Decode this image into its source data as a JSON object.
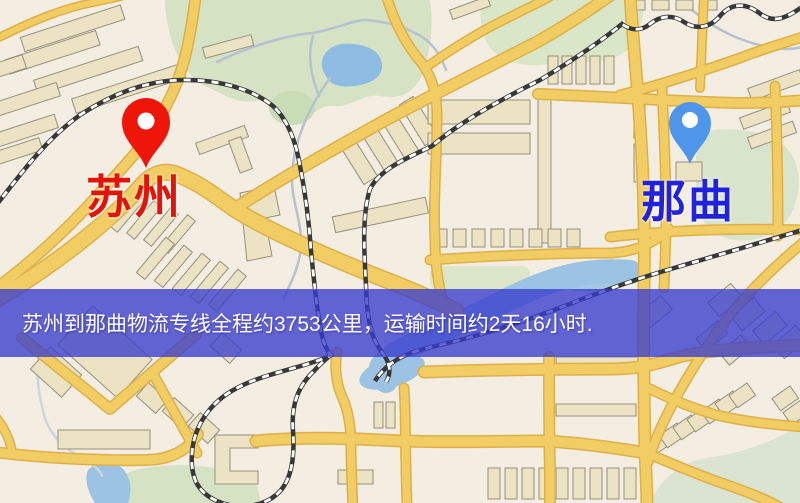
{
  "banner": {
    "text": "苏州到那曲物流专线全程约3753公里，运输时间约2天16小时."
  },
  "markers": {
    "origin": {
      "label": "苏州",
      "label_color": "#e21407",
      "pin_color": "#ee1509"
    },
    "destination": {
      "label": "那曲",
      "label_color": "#2123dc",
      "pin_color": "#4f95ea"
    }
  },
  "map_colors": {
    "background": "#f4ede2",
    "road_fill": "#f2cd63",
    "road_casing": "#ddb04a",
    "building": "#ece2c4",
    "building_outline": "#96907b",
    "park_green": "#d5e3c4",
    "water_blue": "#8fbce2",
    "railway_dark": "#383838",
    "banner_overlay": "rgba(57,60,205,0.78)"
  }
}
